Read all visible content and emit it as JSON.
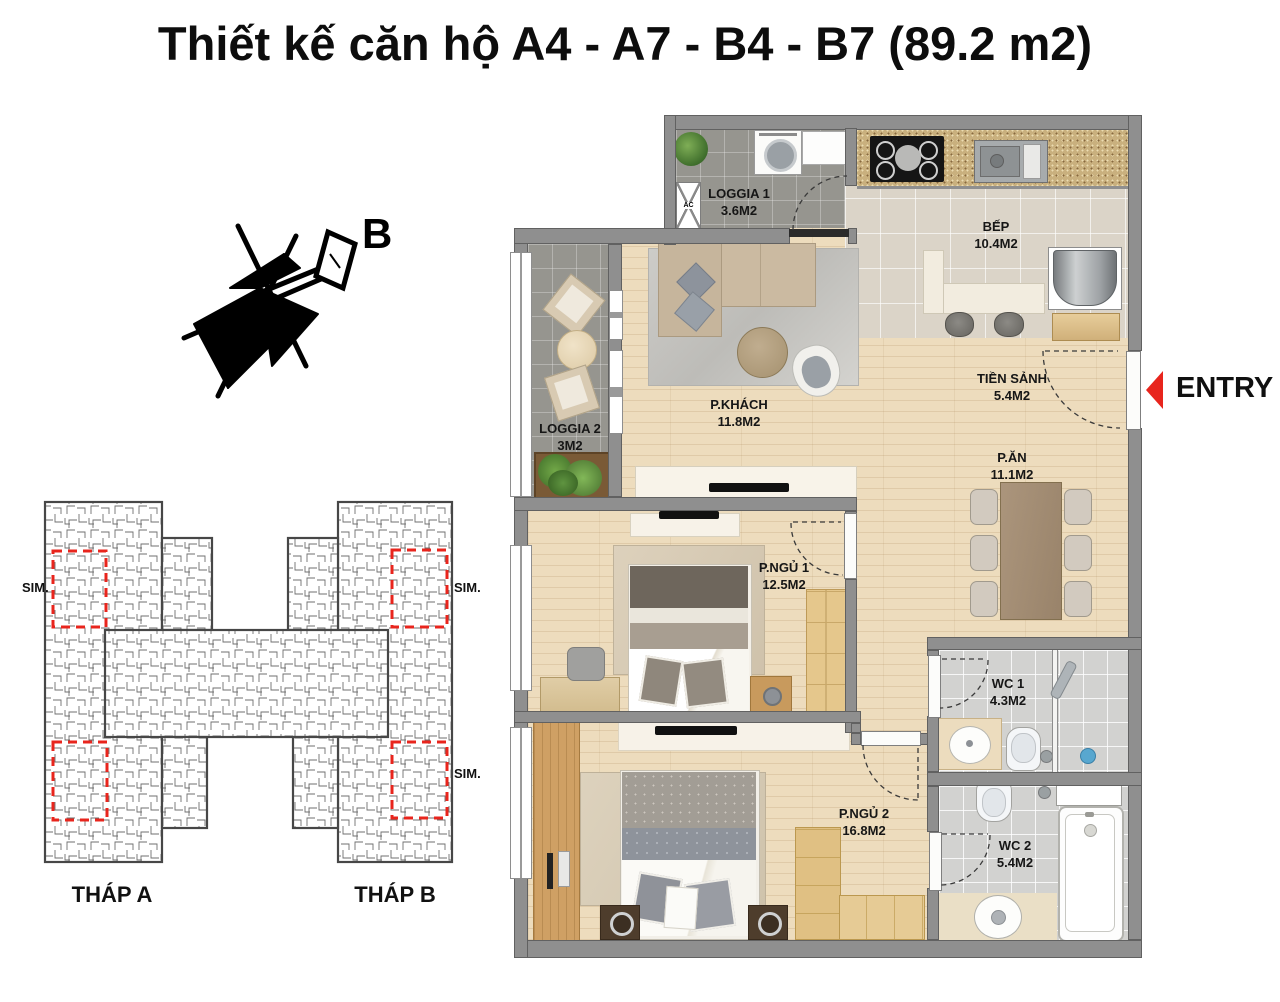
{
  "title": "Thiết kế căn hộ A4 - A7 - B4 - B7 (89.2 m2)",
  "compass": {
    "north_label": "B"
  },
  "key_plan": {
    "tower_a_label": "THÁP A",
    "tower_b_label": "THÁP B",
    "sim_labels": [
      "SIM.",
      "SIM.",
      "SIM."
    ]
  },
  "plan": {
    "entry_label": "ENTRY",
    "ac_label": "AC"
  },
  "rooms": [
    {
      "id": "loggia1",
      "name": "LOGGIA 1",
      "area": "3.6M2"
    },
    {
      "id": "bep",
      "name": "BẾP",
      "area": "10.4M2"
    },
    {
      "id": "tiensanh",
      "name": "TIỀN SẢNH",
      "area": "5.4M2"
    },
    {
      "id": "pkhach",
      "name": "P.KHÁCH",
      "area": "11.8M2"
    },
    {
      "id": "loggia2",
      "name": "LOGGIA 2",
      "area": "3M2"
    },
    {
      "id": "pan",
      "name": "P.ĂN",
      "area": "11.1M2"
    },
    {
      "id": "pngu1",
      "name": "P.NGỦ 1",
      "area": "12.5M2"
    },
    {
      "id": "wc1",
      "name": "WC 1",
      "area": "4.3M2"
    },
    {
      "id": "pngu2",
      "name": "P.NGỦ 2",
      "area": "16.8M2"
    },
    {
      "id": "wc2",
      "name": "WC 2",
      "area": "5.4M2"
    }
  ],
  "colors": {
    "accent_red": "#e8251d",
    "wall_gray": "#8f8f8f",
    "wood_floor": "#eddcbd",
    "kitchen_tile": "#dbd4c8",
    "loggia_tile": "#96958f",
    "bath_tile": "#d2d2d0"
  }
}
